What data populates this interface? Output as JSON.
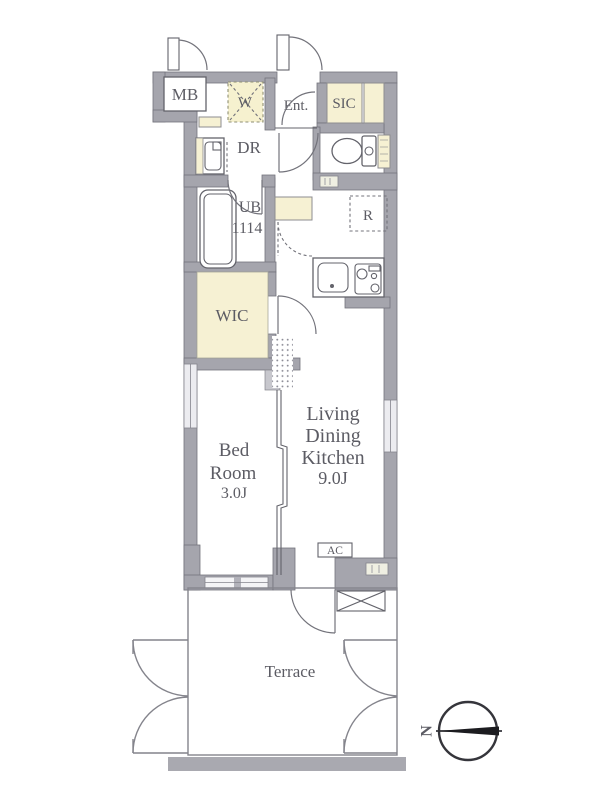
{
  "floorplan": {
    "rooms": {
      "meter_box": {
        "label": "MB"
      },
      "washer_space": {
        "label": "W"
      },
      "entrance": {
        "label": "Ent."
      },
      "shoe_closet": {
        "label": "SIC"
      },
      "dressing_room": {
        "label": "DR"
      },
      "unit_bath": {
        "lines": [
          "UB",
          "1114"
        ]
      },
      "refrigerator_space": {
        "label": "R"
      },
      "walk_in_closet": {
        "label": "WIC"
      },
      "bedroom": {
        "lines": [
          "Bed",
          "Room",
          "3.0J"
        ]
      },
      "living_dining_kitchen": {
        "lines": [
          "Living",
          "Dining",
          "Kitchen",
          "9.0J"
        ]
      },
      "air_conditioner": {
        "label": "AC"
      },
      "terrace": {
        "label": "Terrace"
      }
    },
    "compass": {
      "north_label": "N"
    },
    "colors": {
      "wall": "#a5a5ad",
      "closet_fill": "#f6f1d3",
      "line": "#63636b",
      "text": "#5c5c64",
      "background": "#ffffff"
    }
  }
}
